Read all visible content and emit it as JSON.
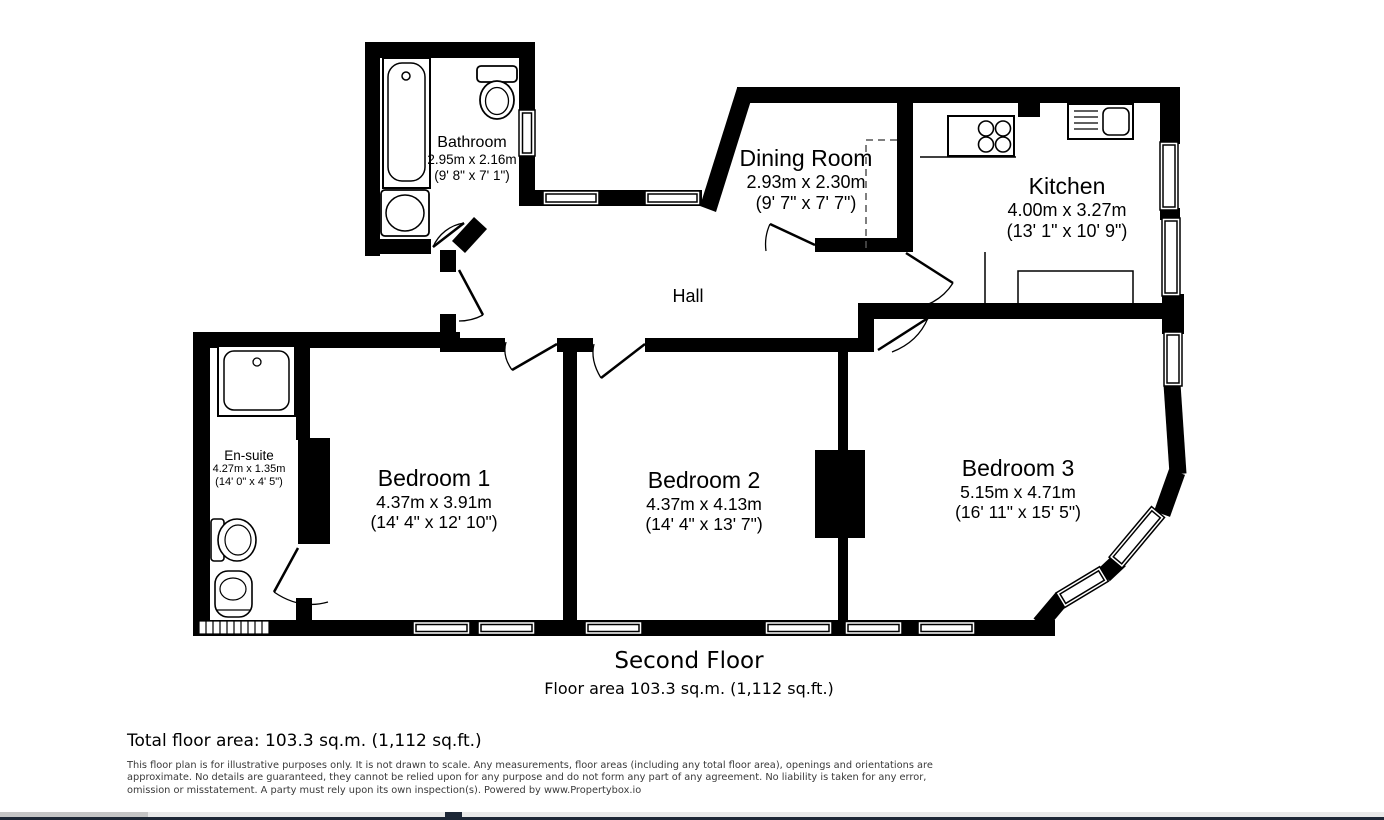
{
  "plan": {
    "rooms": [
      {
        "name": "Bathroom",
        "metric": "2.95m x 2.16m",
        "imperial": "(9' 8\" x 7' 1\")"
      },
      {
        "name": "Dining Room",
        "metric": "2.93m x 2.30m",
        "imperial": "(9' 7\" x 7' 7\")"
      },
      {
        "name": "Kitchen",
        "metric": "4.00m x 3.27m",
        "imperial": "(13' 1\" x 10' 9\")"
      },
      {
        "name": "Hall"
      },
      {
        "name": "En-suite",
        "metric": "4.27m x 1.35m",
        "imperial": "(14' 0\" x 4' 5\")"
      },
      {
        "name": "Bedroom 1",
        "metric": "4.37m x 3.91m",
        "imperial": "(14' 4\" x 12' 10\")"
      },
      {
        "name": "Bedroom 2",
        "metric": "4.37m x 4.13m",
        "imperial": "(14' 4\" x 13' 7\")"
      },
      {
        "name": "Bedroom 3",
        "metric": "5.15m x 4.71m",
        "imperial": "(16' 11\" x 15' 5\")"
      }
    ],
    "fixtures": [
      "bathtub-icon",
      "toilet-icon",
      "basin-icon",
      "shower-icon",
      "hob-icon",
      "sink-icon",
      "towel-rail-icon"
    ]
  },
  "captions": {
    "floor_name": "Second Floor",
    "floor_area": "Floor area 103.3 sq.m. (1,112 sq.ft.)",
    "total_area": "Total floor area: 103.3 sq.m. (1,112 sq.ft.)",
    "disclaimer": "This floor plan is for illustrative purposes only. It is not drawn to scale. Any measurements, floor areas (including any total floor area), openings and orientations are approximate. No details are guaranteed, they cannot be relied upon for any purpose and do not form any part of any agreement. No liability is taken for any error, omission or misstatement. A party must rely upon its own inspection(s). Powered by www.Propertybox.io"
  },
  "colors": {
    "wall": "#000000",
    "bar_grey": "#c5c5c5",
    "bar_light": "#e9e9e9",
    "bar_navy": "#1d2736"
  }
}
